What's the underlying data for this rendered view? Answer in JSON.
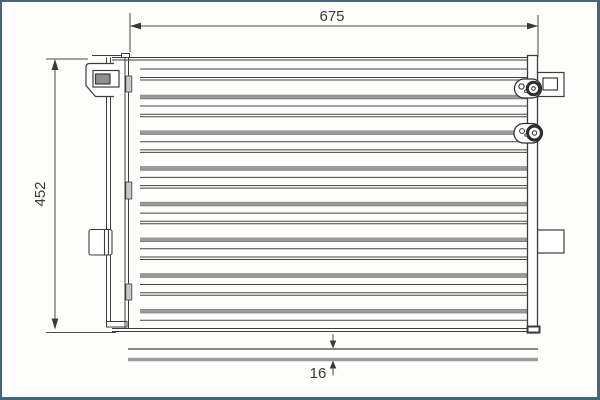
{
  "drawing": {
    "type": "condenser-technical-drawing",
    "dimensions": {
      "width_label": "675",
      "height_label": "452",
      "depth_label": "16"
    },
    "core": {
      "tube_groups": 7
    },
    "colors": {
      "frame": "#456878",
      "line": "#3d3d3d",
      "dark_line": "#444444",
      "tube_gray": "#9a9a9a",
      "tube_edge": "#777777",
      "tab_fill": "#c8c8c8",
      "slot_fill": "#8f8f8f",
      "dim_text": "#3a3a3a"
    }
  }
}
